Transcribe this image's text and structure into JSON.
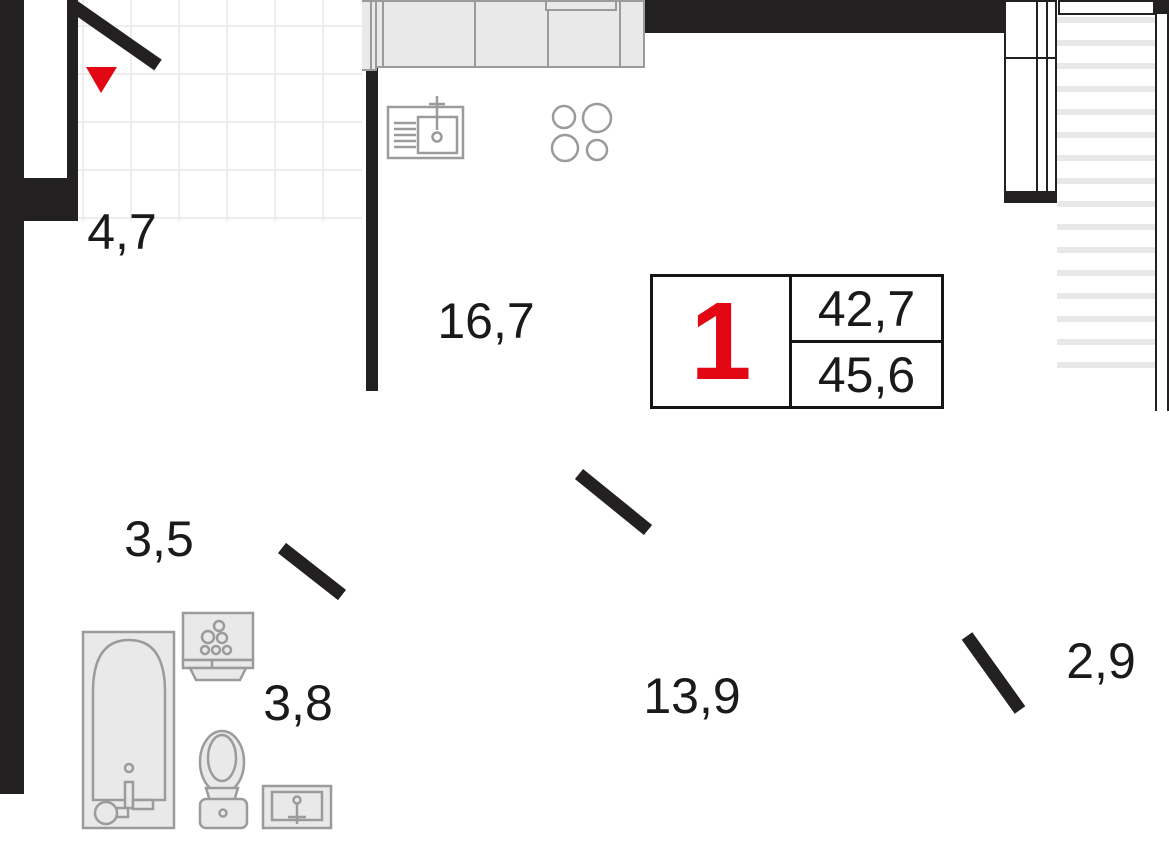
{
  "floor_plan": {
    "unit_info": {
      "rooms_count": "1",
      "living_area": "42,7",
      "total_area": "45,6"
    },
    "room_labels": {
      "hallway": "4,7",
      "kitchen_living_room": "16,7",
      "corridor": "3,5",
      "bathroom": "3,8",
      "bedroom": "13,9",
      "balcony": "2,9"
    },
    "symbols": {
      "fridge_symbol": "✳"
    },
    "colors": {
      "wall": "#232021",
      "accent_red": "#e30613",
      "fixture_fill": "#e9e9e9",
      "fixture_stroke": "#9b9b9b",
      "tile_line": "#ededed",
      "balcony_stripe": "#e8e8e8"
    }
  }
}
